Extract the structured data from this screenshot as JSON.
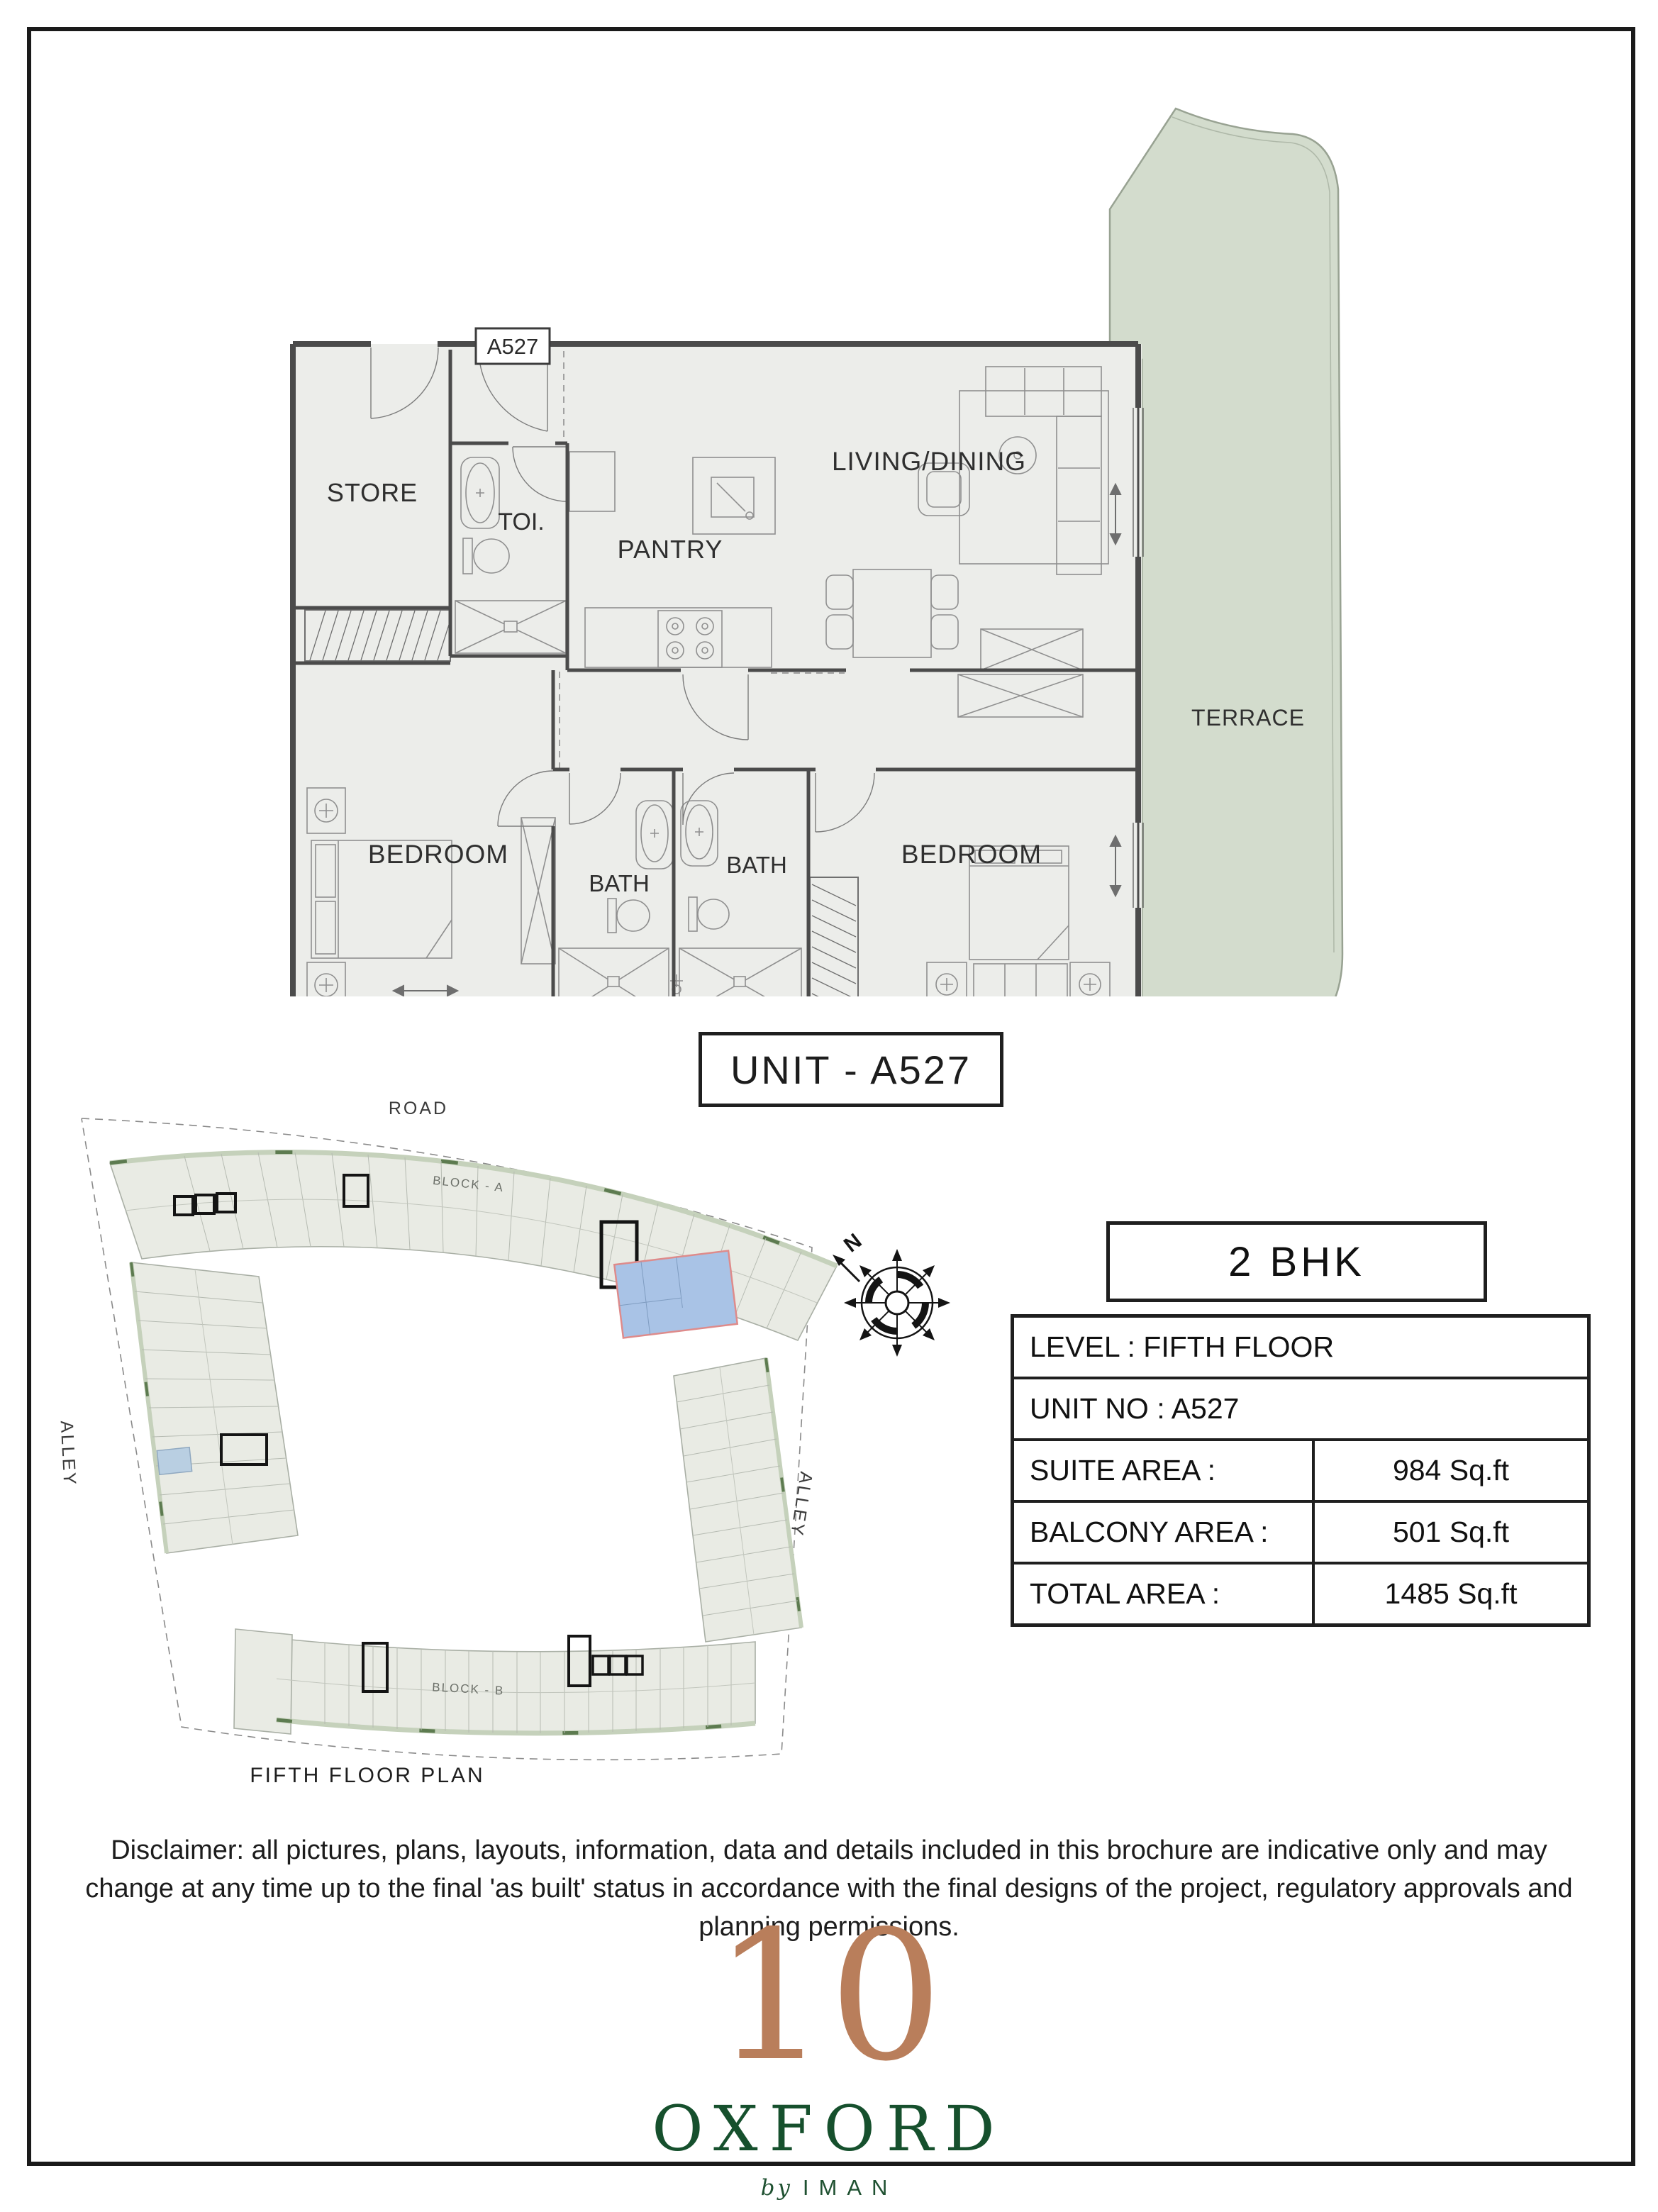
{
  "page": {
    "background": "#ffffff",
    "border_color": "#1a1a1a"
  },
  "floor_plan": {
    "unit_tag": "A527",
    "labels": {
      "store": "STORE",
      "toilet": "TOI.",
      "pantry": "PANTRY",
      "living_dining": "LIVING/DINING",
      "terrace": "TERRACE",
      "bedroom_left": "BEDROOM",
      "bath_left": "BATH",
      "bath_right": "BATH",
      "bedroom_right": "BEDROOM",
      "balcony": "BALCONY"
    }
  },
  "unit_title": "UNIT - A527",
  "site_plan": {
    "road": "ROAD",
    "alley_left": "ALLEY",
    "alley_right": "ALLEY",
    "block_a": "BLOCK - A",
    "block_b": "BLOCK - B",
    "caption": "FIFTH FLOOR PLAN",
    "north": "N"
  },
  "info_panel": {
    "type_badge": "2 BHK",
    "rows": [
      {
        "label": "LEVEL : FIFTH FLOOR",
        "value": ""
      },
      {
        "label": "UNIT NO : A527",
        "value": ""
      },
      {
        "label": "SUITE AREA :",
        "value": "984 Sq.ft"
      },
      {
        "label": "BALCONY AREA :",
        "value": "501 Sq.ft"
      },
      {
        "label": "TOTAL AREA :",
        "value": "1485 Sq.ft"
      }
    ]
  },
  "disclaimer": "Disclaimer: all pictures, plans, layouts, information, data and details included in this brochure are indicative only and may change at any time up to the final 'as built' status in accordance with the final designs of the project, regulatory approvals and planning permissions.",
  "logo": {
    "number": "10",
    "name": "OXFORD",
    "by": "by",
    "brand": "IMAN"
  },
  "colors": {
    "sage_green": "#d3dccd",
    "plan_floor": "#ecedea",
    "wall_gray": "#4b4b4b",
    "copper": "#b97e5b",
    "brand_green": "#16502d",
    "highlight_blue": "#a9c3e6",
    "highlight_border": "#de8b8b"
  }
}
